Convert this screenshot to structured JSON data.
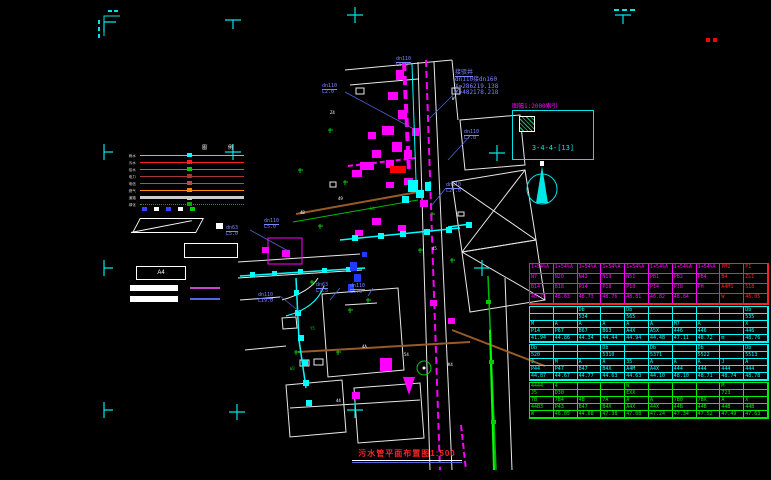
{
  "drawing": {
    "scale_note": "图幅1:2000索引",
    "index_code": "3-4-4-[13]",
    "title": "污水管平面布置图1:500"
  },
  "colors": {
    "cyan": "#00ffff",
    "magenta": "#ff00ff",
    "red": "#ff2222",
    "green": "#00cc00",
    "blue_label": "#7b86ff",
    "brown": "#9a5a28",
    "white": "#ffffff"
  },
  "annotation_block": {
    "lines": [
      "接驳井",
      "dn110接dn160",
      "X=286219.138",
      "Y=482178.218"
    ]
  },
  "legend": {
    "headers": [
      "图",
      "例"
    ],
    "rows": [
      {
        "label": "雨水",
        "color": "#00ffff",
        "style": "solid",
        "width": 1
      },
      {
        "label": "污水",
        "color": "#ff2222",
        "style": "solid",
        "width": 1
      },
      {
        "label": "给水",
        "color": "#00cc00",
        "style": "solid",
        "width": 1
      },
      {
        "label": "电力",
        "color": "#aa3333",
        "style": "solid",
        "width": 1
      },
      {
        "label": "电信",
        "color": "#aa5544",
        "style": "solid",
        "width": 1
      },
      {
        "label": "燃气",
        "color": "#ff8800",
        "style": "solid",
        "width": 1
      },
      {
        "label": "道路",
        "color": "#cccccc",
        "style": "solid",
        "width": 3
      },
      {
        "label": "绿化",
        "color": "#00aa00",
        "style": "dotted",
        "width": 1
      }
    ],
    "symbol_row": [
      "#3344ff",
      "#ffffff",
      "#3344ff",
      "#ffffff",
      "#00cc00"
    ],
    "a4_label": "A4",
    "bar_lines": [
      {
        "color": "#cc44cc"
      },
      {
        "color": "#5566dd"
      }
    ]
  },
  "map_labels": [
    {
      "t1": "dn110",
      "t2": "L2.0",
      "x": 322,
      "y": 84
    },
    {
      "t1": "dn110",
      "t2": "L5.0",
      "x": 396,
      "y": 57
    },
    {
      "t1": "dn110",
      "t2": "L7.0",
      "x": 464,
      "y": 130
    },
    {
      "t1": "dn110",
      "t2": "L27.0",
      "x": 446,
      "y": 183
    },
    {
      "t1": "dn63",
      "t2": "L5.0",
      "x": 226,
      "y": 226
    },
    {
      "t1": "dn110",
      "t2": "L5.0",
      "x": 264,
      "y": 219
    },
    {
      "t1": "dn110",
      "t2": "L19.0",
      "x": 258,
      "y": 293
    },
    {
      "t1": "dn63",
      "t2": "L7.5",
      "x": 316,
      "y": 283
    },
    {
      "t1": "dn110",
      "t2": "L5.0",
      "x": 350,
      "y": 284
    }
  ],
  "tiny_labels": [
    {
      "t": "4B",
      "x": 300,
      "y": 210,
      "c": "#ffffff"
    },
    {
      "t": "49",
      "x": 338,
      "y": 196,
      "c": "#ffffff"
    },
    {
      "t": "W4",
      "x": 370,
      "y": 206,
      "c": "#00cc00"
    },
    {
      "t": "45",
      "x": 432,
      "y": 246,
      "c": "#ffffff"
    },
    {
      "t": "Y5",
      "x": 310,
      "y": 326,
      "c": "#00cc00"
    },
    {
      "t": "4A",
      "x": 362,
      "y": 344,
      "c": "#ffffff"
    },
    {
      "t": "54",
      "x": 404,
      "y": 352,
      "c": "#ffffff"
    },
    {
      "t": "W3",
      "x": 290,
      "y": 366,
      "c": "#00cc00"
    },
    {
      "t": "44",
      "x": 336,
      "y": 398,
      "c": "#ffffff"
    },
    {
      "t": "K4",
      "x": 448,
      "y": 362,
      "c": "#ffffff"
    },
    {
      "t": "Z4",
      "x": 330,
      "y": 110,
      "c": "#ffffff"
    },
    {
      "t": "W",
      "x": 452,
      "y": 96,
      "c": "#ffffff"
    }
  ],
  "grid_marks": [
    {
      "x": 104,
      "y": 22,
      "type": "corner"
    },
    {
      "x": 233,
      "y": 20,
      "type": "tee-down"
    },
    {
      "x": 355,
      "y": 15,
      "type": "cross"
    },
    {
      "x": 623,
      "y": 15,
      "type": "tee-down"
    },
    {
      "x": 104,
      "y": 152,
      "type": "tee-right"
    },
    {
      "x": 233,
      "y": 152,
      "type": "cross"
    },
    {
      "x": 497,
      "y": 153,
      "type": "cross"
    },
    {
      "x": 104,
      "y": 268,
      "type": "tee-right"
    },
    {
      "x": 482,
      "y": 268,
      "type": "cross"
    },
    {
      "x": 104,
      "y": 410,
      "type": "tee-right"
    },
    {
      "x": 237,
      "y": 412,
      "type": "cross"
    },
    {
      "x": 355,
      "y": 410,
      "type": "cross"
    }
  ],
  "table": {
    "sections": [
      {
        "color": "#ff00ff",
        "border": "#ff2222",
        "red_cols": [
          8,
          9
        ],
        "rows": [
          [
            "1+54%A",
            "1+54%A",
            "1+54%A",
            "1+54%A",
            "1+54%A",
            "1+54%A",
            "1+54%A",
            "1+54%A",
            "PM2",
            "P1"
          ],
          [
            "N7",
            "N20",
            "N42",
            "N19",
            "N51",
            "PB1",
            "PB2",
            "PB4",
            "B4",
            "ZL1"
          ],
          [
            "B14",
            "B18",
            "P14",
            "P18",
            "P18",
            "P14",
            "P18",
            "PH",
            "A4M1",
            "S18"
          ],
          [
            "48.74",
            "48.63",
            "48.73",
            "48.76",
            "48.81",
            "46.82",
            "48.84",
            "",
            "W",
            "46.05"
          ]
        ]
      },
      {
        "color": "#00ffff",
        "border": "#00ffff",
        "red_cols": [],
        "rows": [
          [
            "",
            "",
            "Db",
            "",
            "Db",
            "",
            "",
            "",
            "",
            "Db"
          ],
          [
            "",
            "",
            "534",
            "",
            "565",
            "",
            "",
            "",
            "",
            "535"
          ],
          [
            "M",
            "A",
            "A",
            "A",
            "A",
            "A",
            "M7",
            "A",
            "",
            "X"
          ],
          [
            "P14",
            "P67",
            "B67",
            "B63",
            "A4X",
            "A5X",
            "446",
            "446",
            "",
            "446"
          ],
          [
            "41.94",
            "44.86",
            "44.34",
            "44.44",
            "44.94",
            "44.48",
            "47.11",
            "48.72",
            "m",
            "48.76"
          ]
        ]
      },
      {
        "color": "#00ffff",
        "border": "#00ffff",
        "red_cols": [],
        "rows": [
          [
            "Db",
            "",
            "",
            "Db",
            "",
            "Db",
            "",
            "Db",
            "",
            "Db"
          ],
          [
            "520",
            "",
            "",
            "5310",
            "",
            "5371",
            "",
            "5522",
            "",
            "5513"
          ],
          [
            "J",
            "M",
            "A",
            "A",
            "35",
            "A",
            "A",
            "A",
            "J",
            "A"
          ],
          [
            "P44",
            "P47",
            "B47",
            "B4X",
            "A4M",
            "A4X",
            "444",
            "444",
            "444",
            "444"
          ],
          [
            "44.87",
            "44.67",
            "44.77",
            "44.63",
            "44.63",
            "44.10",
            "48.10",
            "48.71",
            "48.74",
            "48.78"
          ]
        ]
      },
      {
        "color": "#00ee00",
        "border": "#00ee00",
        "red_cols": [],
        "rows": [
          [
            "4444",
            "4",
            "",
            "",
            "W",
            "",
            "",
            "",
            "M",
            ""
          ],
          [
            "J5",
            "D30",
            "",
            "",
            "EXX",
            "",
            "",
            "",
            "723",
            ""
          ],
          [
            "7B",
            "7B4",
            "4B",
            "7A",
            "A",
            "A",
            "7B0",
            "7BX",
            "A",
            "X"
          ],
          [
            "44B3",
            "P43",
            "B47",
            "B4X",
            "A4X",
            "44X",
            "44B",
            "44B",
            "44B",
            "44B"
          ],
          [
            "W",
            "46.05",
            "44.68",
            "47.38",
            "47.08",
            "47.24",
            "47.34",
            "47.52",
            "47.49",
            "47.63"
          ]
        ]
      }
    ]
  }
}
